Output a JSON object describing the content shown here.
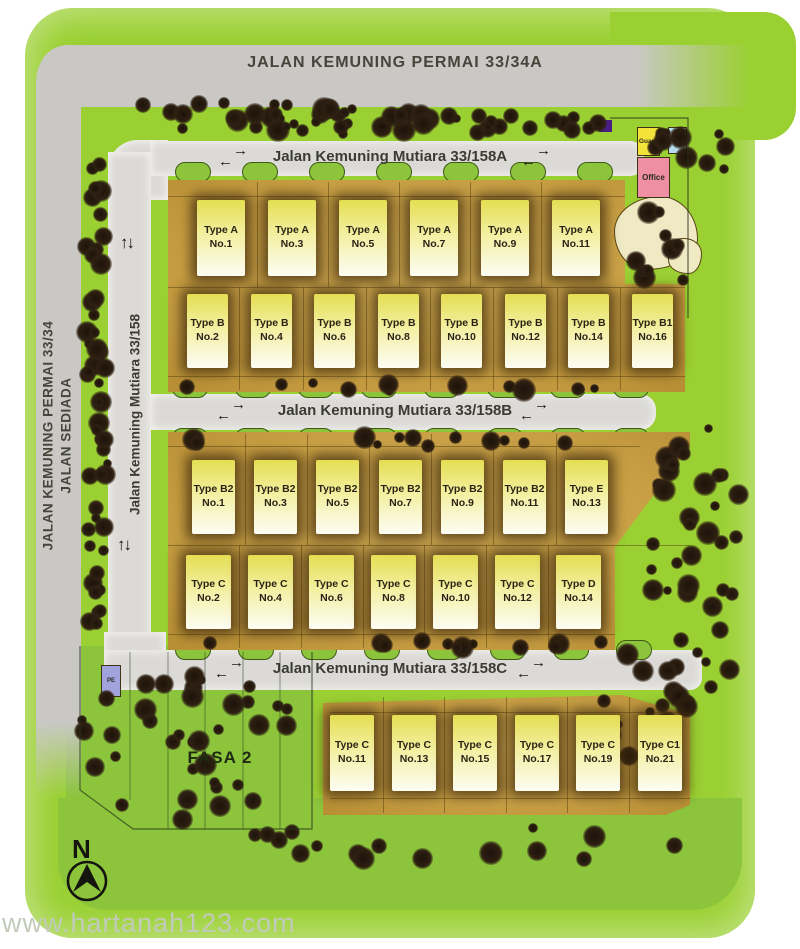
{
  "page": {
    "watermark": "www.hartanah123.com"
  },
  "roads": {
    "outer_top": "JALAN KEMUNING PERMAI 33/34A",
    "outer_left_line1": "JALAN KEMUNING PERMAI 33/34",
    "outer_left_line2": "JALAN SEDIADA",
    "inner_a": "Jalan Kemuning Mutiara 33/158A",
    "inner_vertical": "Jalan Kemuning Mutiara 33/158",
    "inner_b": "Jalan Kemuning Mutiara 33/158B",
    "inner_c": "Jalan Kemuning Mutiara 33/158C"
  },
  "amenities": {
    "guard": "Guard",
    "pe_top": "PE",
    "office": "Office",
    "pe_left": "PE"
  },
  "phase_label": "FASA 2",
  "compass_n": "N",
  "icons": {
    "right_arrow": "→",
    "left_arrow": "←",
    "up_arrow": "↑",
    "down_arrow": "↓"
  },
  "colors": {
    "lime_green": "#9ad032",
    "grass_green": "#8cc43c",
    "outer_road": "#c9c8c4",
    "inner_road": "#dbdad6",
    "lot_tan": "#c79e43",
    "house_yellow": "#f3efa0",
    "guard_yellow": "#f2e23a",
    "pe_blue": "#b8dcee",
    "office_pink": "#ee8fa4",
    "pe_left_purple": "#a2a2dd",
    "marker_purple": "#4b1e86",
    "pond_cream": "#efe9c4",
    "tree_brown": "#2e2012"
  },
  "house_rows": [
    {
      "name": "row-type-a",
      "houses": [
        {
          "type": "Type A",
          "no": "No.1"
        },
        {
          "type": "Type A",
          "no": "No.3"
        },
        {
          "type": "Type A",
          "no": "No.5"
        },
        {
          "type": "Type A",
          "no": "No.7"
        },
        {
          "type": "Type A",
          "no": "No.9"
        },
        {
          "type": "Type A",
          "no": "No.11"
        }
      ]
    },
    {
      "name": "row-type-b",
      "houses": [
        {
          "type": "Type B",
          "no": "No.2"
        },
        {
          "type": "Type B",
          "no": "No.4"
        },
        {
          "type": "Type B",
          "no": "No.6"
        },
        {
          "type": "Type B",
          "no": "No.8"
        },
        {
          "type": "Type B",
          "no": "No.10"
        },
        {
          "type": "Type B",
          "no": "No.12"
        },
        {
          "type": "Type B",
          "no": "No.14"
        },
        {
          "type": "Type B1",
          "no": "No.16"
        }
      ]
    },
    {
      "name": "row-type-b2",
      "houses": [
        {
          "type": "Type B2",
          "no": "No.1"
        },
        {
          "type": "Type B2",
          "no": "No.3"
        },
        {
          "type": "Type B2",
          "no": "No.5"
        },
        {
          "type": "Type B2",
          "no": "No.7"
        },
        {
          "type": "Type B2",
          "no": "No.9"
        },
        {
          "type": "Type B2",
          "no": "No.11"
        },
        {
          "type": "Type E",
          "no": "No.13"
        }
      ]
    },
    {
      "name": "row-type-c",
      "houses": [
        {
          "type": "Type C",
          "no": "No.2"
        },
        {
          "type": "Type C",
          "no": "No.4"
        },
        {
          "type": "Type C",
          "no": "No.6"
        },
        {
          "type": "Type C",
          "no": "No.8"
        },
        {
          "type": "Type C",
          "no": "No.10"
        },
        {
          "type": "Type C",
          "no": "No.12"
        },
        {
          "type": "Type D",
          "no": "No.14"
        }
      ]
    },
    {
      "name": "row-type-c-south",
      "houses": [
        {
          "type": "Type C",
          "no": "No.11"
        },
        {
          "type": "Type C",
          "no": "No.13"
        },
        {
          "type": "Type C",
          "no": "No.15"
        },
        {
          "type": "Type C",
          "no": "No.17"
        },
        {
          "type": "Type C",
          "no": "No.19"
        },
        {
          "type": "Type C1",
          "no": "No.21"
        }
      ]
    }
  ]
}
